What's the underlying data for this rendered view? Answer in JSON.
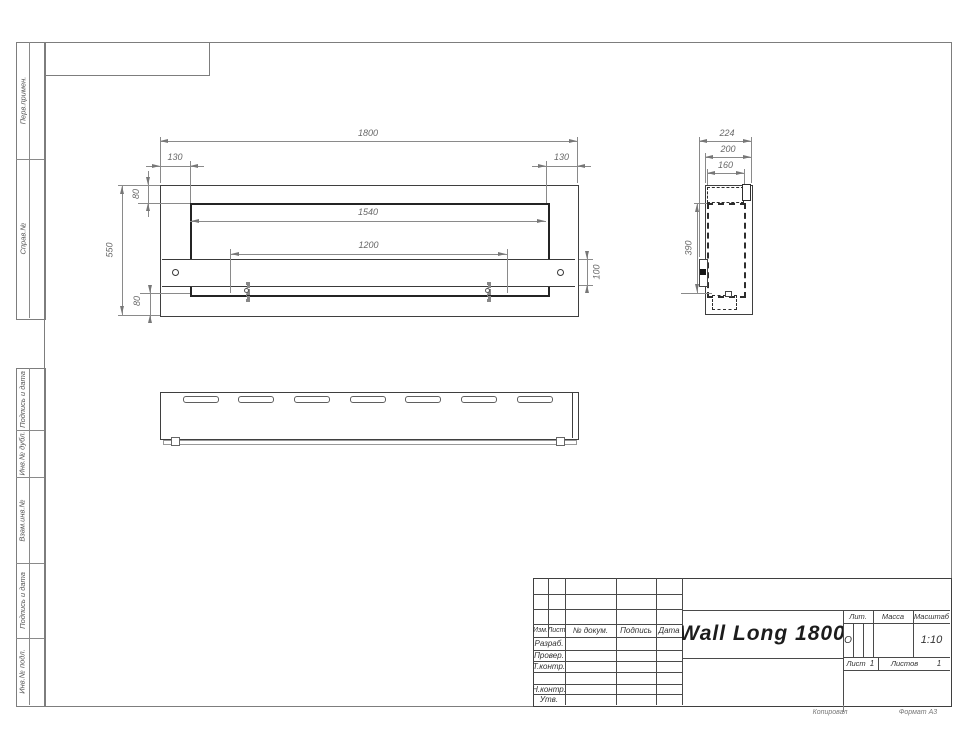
{
  "colors": {
    "line_thick": "#2f2f2f",
    "line_thin": "#8a8a8a",
    "dimension_text": "#686868",
    "title_text": "#1c1c1c"
  },
  "sidebar": {
    "perv_primen": "Перв.примен.",
    "sprav_no": "Справ.№",
    "podpis_data_top": "Подпись и дата",
    "inv_dubl": "Инв.№ дубл.",
    "vzam_inv": "Взам.инв.№",
    "podpis_data_bottom": "Подпись и дата",
    "inv_podl": "Инв.№ подл."
  },
  "front_view": {
    "dims": {
      "overall_width": "1800",
      "left_offset": "130",
      "right_offset": "130",
      "top_flange": "80",
      "inner_width": "1540",
      "mount_holes_span": "1200",
      "overall_height": "550",
      "bracket_height": "100",
      "bottom_flange": "80"
    }
  },
  "side_view": {
    "dims": {
      "overall_depth": "224",
      "body_depth": "200",
      "inner_depth": "160",
      "opening_height": "390"
    }
  },
  "title_block": {
    "columns": {
      "izm": "Изм.",
      "list": "Лист",
      "n_dokum": "№ докум.",
      "podpis": "Подпись",
      "data": "Дата"
    },
    "rows": {
      "razrab": "Разраб.",
      "prover": "Провер.",
      "t_kontr": "Т.контр.",
      "n_kontr": "Н.контр.",
      "utv": "Утв."
    },
    "title": "Wall Long 1800",
    "lit_header": "Лит.",
    "lit_value": "О",
    "massa_header": "Масса",
    "masshtab_header": "Масштаб",
    "masshtab_value": "1:10",
    "list_label": "Лист",
    "list_value": "1",
    "listov_label": "Листов",
    "listov_value": "1"
  },
  "footer": {
    "kopiroval": "Копировал",
    "format": "Формат А3"
  }
}
